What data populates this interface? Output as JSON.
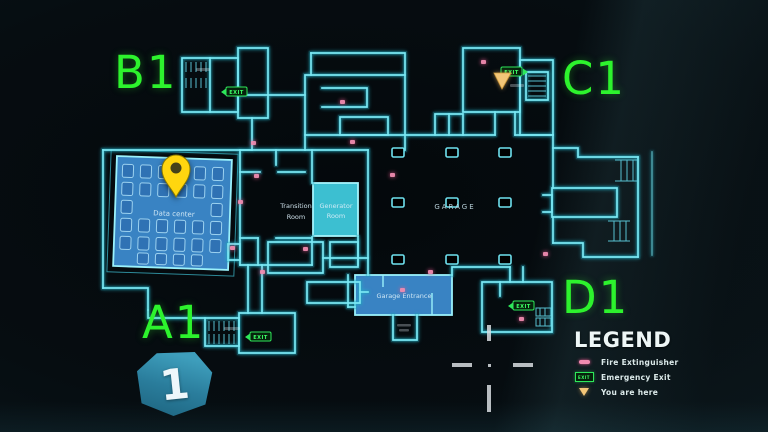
{
  "quadrants": {
    "b1": "B1",
    "c1": "C1",
    "a1": "A1",
    "d1": "D1"
  },
  "rooms": {
    "data_center": {
      "label": "Data center"
    },
    "transition_room": {
      "line1": "Transition",
      "line2": "Room"
    },
    "generator_room": {
      "line1": "Generator",
      "line2": "Room"
    },
    "garage": {
      "label": "GARAGE"
    },
    "garage_entrance": {
      "label": "Garage Entrance"
    }
  },
  "markers": {
    "exit_label": "EXIT",
    "waypoint_pin": "yellow-map-pin",
    "you_are_here": "orange-triangle",
    "fire_extinguisher_dot": "pink-dot"
  },
  "legend": {
    "title": "LEGEND",
    "items": [
      {
        "icon": "fire-extinguisher-icon",
        "label": "Fire Extinguisher"
      },
      {
        "icon": "emergency-exit-icon",
        "label": "Emergency Exit"
      },
      {
        "icon": "you-are-here-icon",
        "label": "You are here"
      }
    ]
  },
  "floor_badge": {
    "number": "1"
  },
  "colors": {
    "wall_cyan": "#7ae8f4",
    "room_blue": "#3e8ed2",
    "room_cyan": "#3fc9dc",
    "exit_green": "#3dff66",
    "quadrant_green": "#2df32d",
    "pin_yellow": "#ffd60f",
    "here_orange": "#f3c678",
    "fire_pink": "#f08bb0"
  }
}
